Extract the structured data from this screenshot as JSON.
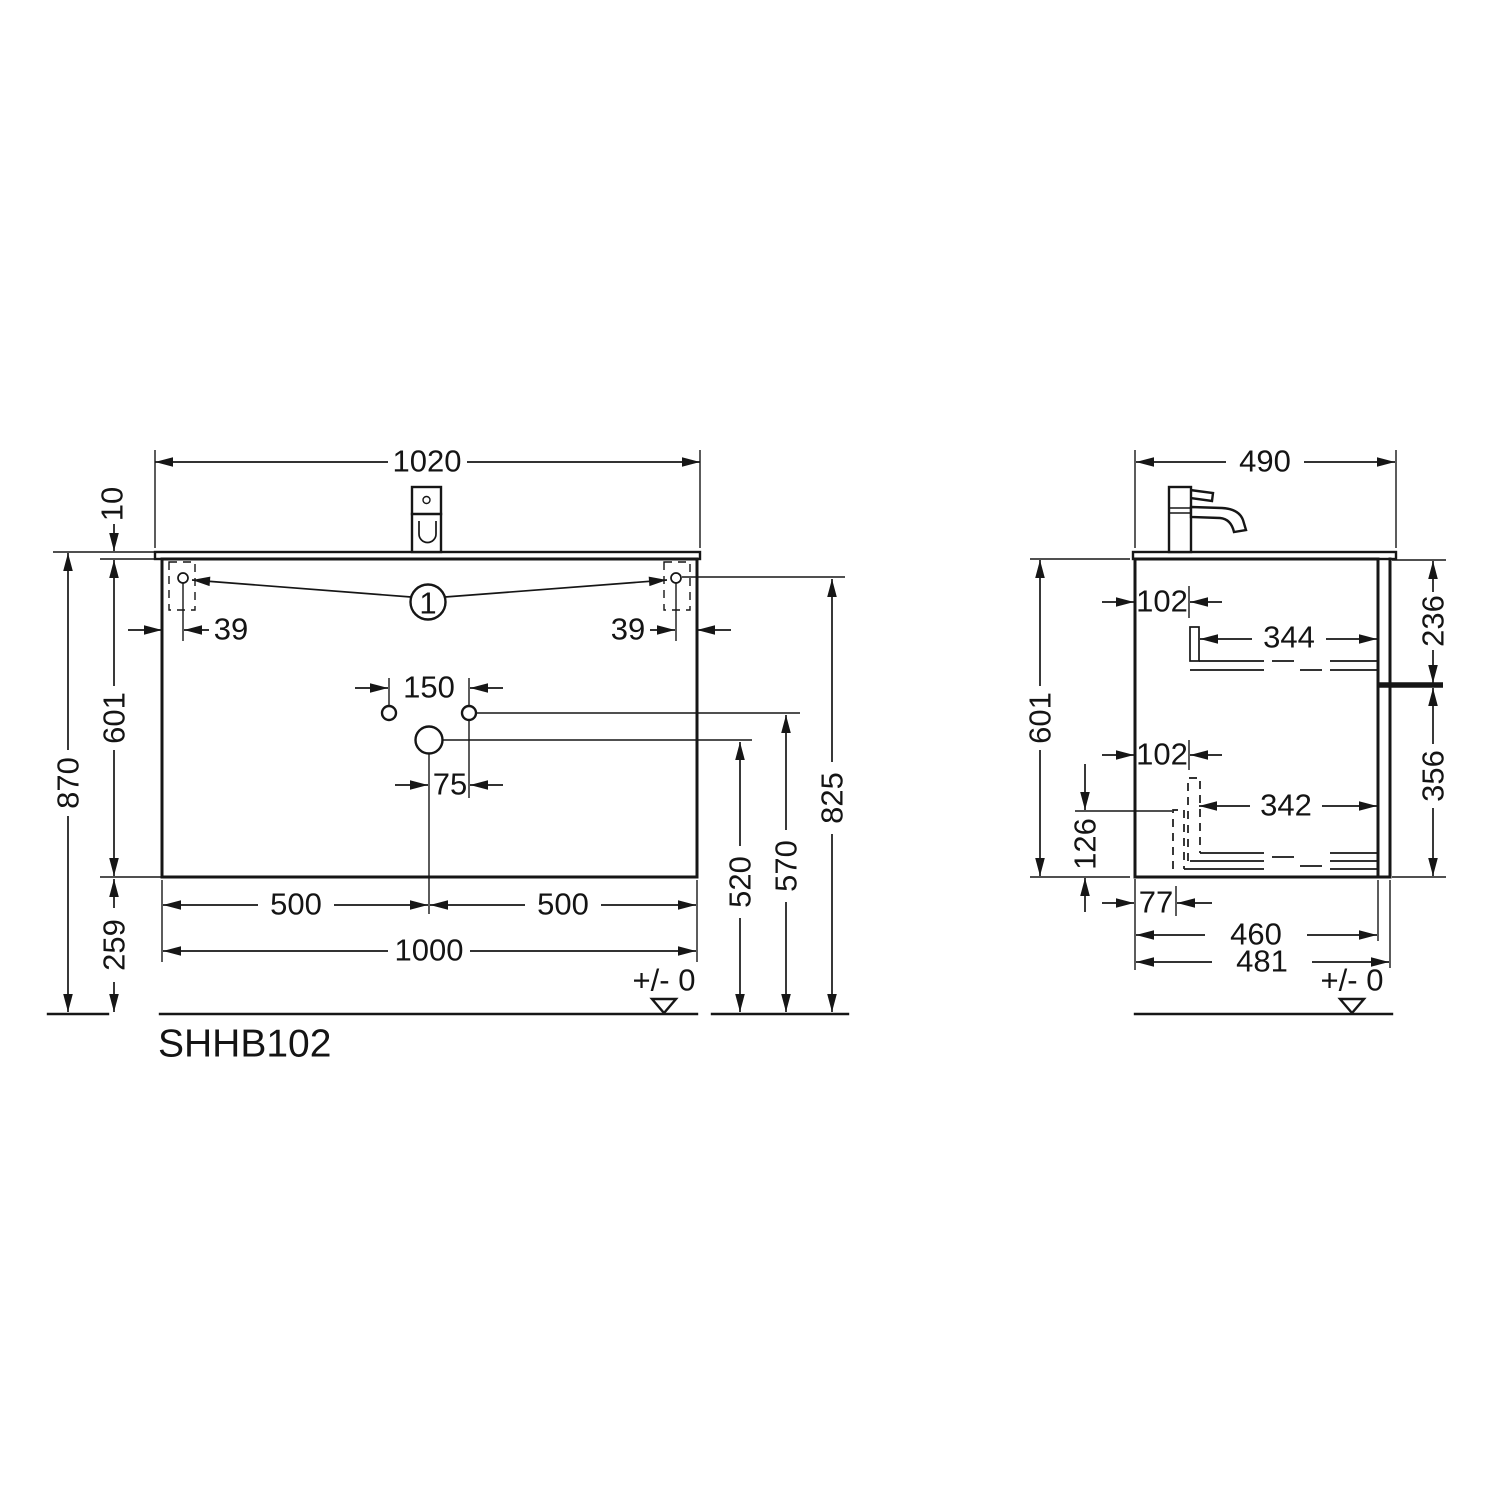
{
  "drawing": {
    "model": "SHHB102",
    "balloon": "1"
  },
  "front": {
    "basin_width": "1020",
    "basin_thickness": "10",
    "bracket_offset_left": "39",
    "bracket_offset_right": "39",
    "tap_hole_spacing": "150",
    "drain_offset": "75",
    "cabinet_height": "601",
    "overall_height": "870",
    "bottom_clearance": "259",
    "half_width_left": "500",
    "half_width_right": "500",
    "cabinet_width": "1000",
    "drain_height": "520",
    "hole_height": "570",
    "bracket_height": "825",
    "datum": "+/- 0"
  },
  "side": {
    "worktop_depth": "490",
    "runner_setback_top": "102",
    "runner_length_top": "344",
    "top_drawer_front": "236",
    "cabinet_height": "601",
    "runner_setback_bottom": "102",
    "runner_length_bottom": "342",
    "bottom_drawer_front": "356",
    "drawer_box_height": "126",
    "drawer_box_setback": "77",
    "cabinet_depth": "460",
    "overall_depth": "481",
    "datum": "+/- 0"
  }
}
